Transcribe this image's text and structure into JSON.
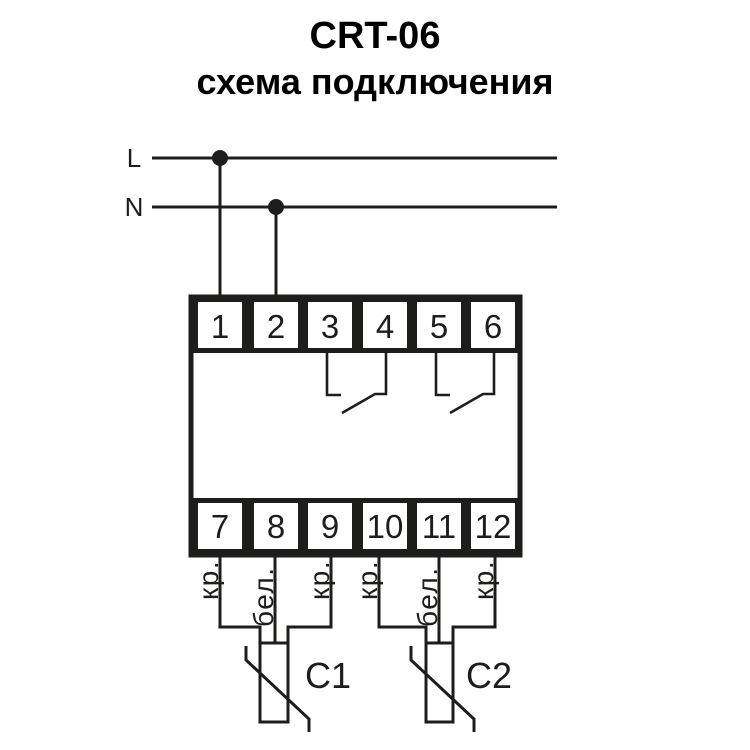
{
  "title": {
    "model": "CRT-06",
    "subtitle": "схема подключения"
  },
  "power": {
    "phase_label": "L",
    "neutral_label": "N"
  },
  "device": {
    "top_terminals": [
      "1",
      "2",
      "3",
      "4",
      "5",
      "6"
    ],
    "bottom_terminals": [
      "7",
      "8",
      "9",
      "10",
      "11",
      "12"
    ]
  },
  "sensors": [
    {
      "label": "C1",
      "wire_labels": [
        "кр.",
        "бел.",
        "кр."
      ]
    },
    {
      "label": "C2",
      "wire_labels": [
        "кр.",
        "бел.",
        "кр."
      ]
    }
  ],
  "colors": {
    "ink": "#1d1d1b",
    "background": "#ffffff"
  }
}
